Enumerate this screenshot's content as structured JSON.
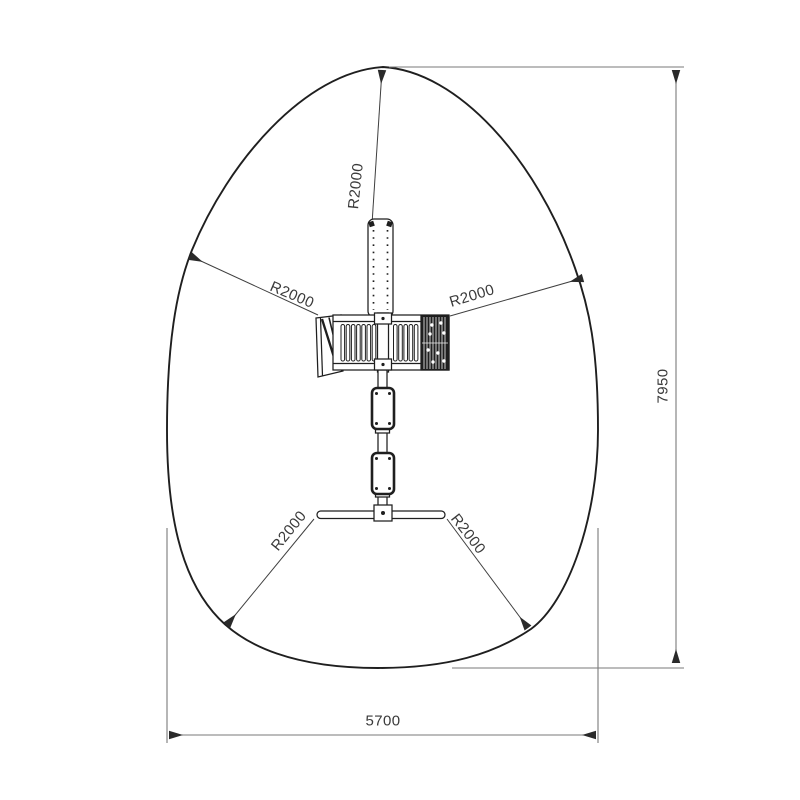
{
  "labels": {
    "radius_top": "R2000",
    "radius_upper_left": "R2000",
    "radius_upper_right": "R2000",
    "radius_lower_left": "R2000",
    "radius_lower_right": "R2000",
    "total_height": "7950",
    "total_width": "5700"
  },
  "colors": {
    "line": "#1f1f1f",
    "dimension_line": "#7a7a7a",
    "leader_line": "#3f3f3f",
    "arrow": "#2a2a2a",
    "text": "#3a3a3a",
    "background": "#ffffff"
  }
}
